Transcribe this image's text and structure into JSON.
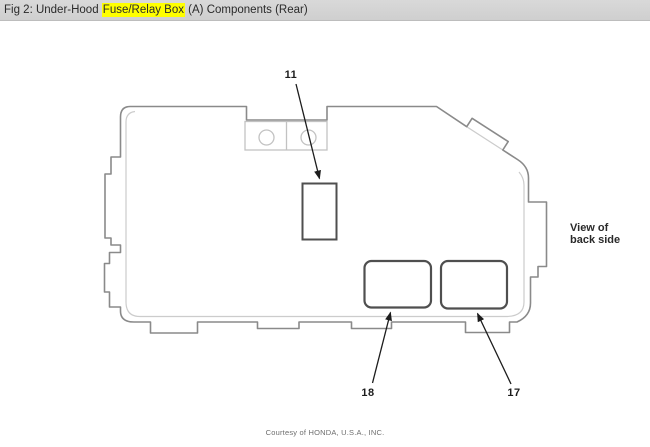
{
  "header": {
    "prefix": "Fig 2: Under-Hood ",
    "highlight": "Fuse/Relay Box",
    "suffix": " (A) Components (Rear)"
  },
  "colors": {
    "header_bg": "#d3d3d3",
    "highlight_bg": "#ffff00",
    "box_outline_gray": "#8a8a8a",
    "inner_line_gray": "#cccccc",
    "bracket_gray": "#c2c2c2",
    "component_stroke": "#4f4f4f",
    "arrow_black": "#1c1c1c",
    "footer_gray": "#6e6e6e"
  },
  "diagram": {
    "callouts": [
      {
        "label": "11"
      },
      {
        "label": "17"
      },
      {
        "label": "18"
      }
    ],
    "view_note": "View of\nback side",
    "footer": "Courtesy of HONDA, U.S.A., INC."
  }
}
